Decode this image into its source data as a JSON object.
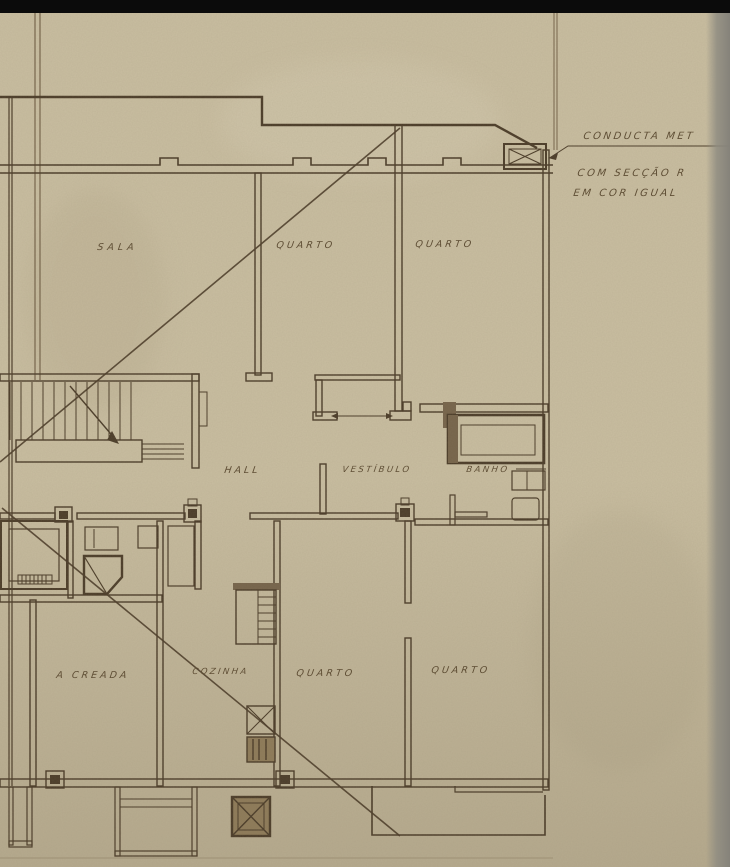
{
  "document_kind": "scanned architectural floor plan (apartment storey plan)",
  "colors": {
    "paper": "#c9bea1",
    "paper_shadow": "#b4a98c",
    "paper_light": "#d4cab0",
    "ink": "#4a3b28",
    "ink_light": "#75634a",
    "ink_text": "#5a4930",
    "black_strip": "#0b0b0b",
    "scan_edge": "#8f8c81",
    "duct_fill": "#8d7a58"
  },
  "plan": {
    "rooms": [
      {
        "id": "sala",
        "label": "SALA"
      },
      {
        "id": "quarto-top-1",
        "label": "QUARTO"
      },
      {
        "id": "quarto-top-2",
        "label": "QUARTO"
      },
      {
        "id": "hall",
        "label": "HALL"
      },
      {
        "id": "vestibulo",
        "label": "VESTÍBULO"
      },
      {
        "id": "banho",
        "label": "BANHO"
      },
      {
        "id": "quarto-creada",
        "label": "A CREADA"
      },
      {
        "id": "cozinha",
        "label": "COZINHA"
      },
      {
        "id": "quarto-bottom-1",
        "label": "QUARTO"
      },
      {
        "id": "quarto-bottom-2",
        "label": "QUARTO"
      }
    ],
    "annotations": [
      {
        "id": "note-1",
        "text": "CONDUCTA MET"
      },
      {
        "id": "note-2",
        "text": "COM SECÇÃO R"
      },
      {
        "id": "note-3",
        "text": "EM COR IGUAL"
      }
    ],
    "symbols": [
      {
        "id": "conducta-duct",
        "meaning": "metal duct symbol (hatched box) on right facade"
      },
      {
        "id": "stair-run",
        "meaning": "staircase with direction arrow"
      },
      {
        "id": "bathtub",
        "meaning": "bathtub in BANHO"
      },
      {
        "id": "kitchen-flue",
        "meaning": "kitchen duct / flue boxes"
      }
    ]
  }
}
